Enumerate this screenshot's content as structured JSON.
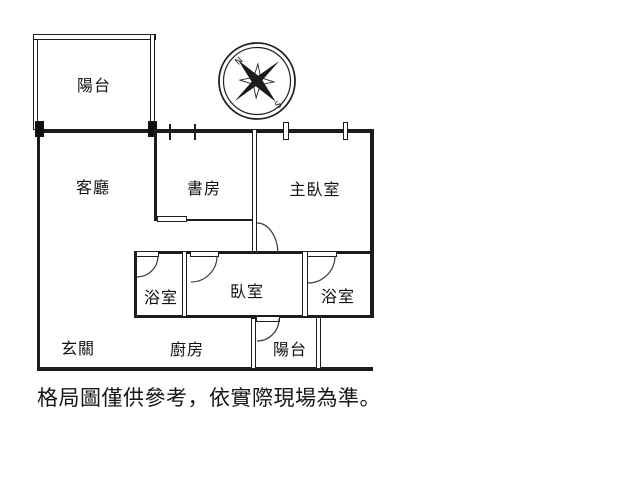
{
  "page": {
    "background_color": "#ffffff",
    "line_color": "#1c1c1c",
    "text_color": "#111111"
  },
  "floorplan": {
    "rooms": [
      {
        "id": "balcony-top",
        "label": "陽台"
      },
      {
        "id": "living-room",
        "label": "客廳"
      },
      {
        "id": "study",
        "label": "書房"
      },
      {
        "id": "master-bedroom",
        "label": "主臥室"
      },
      {
        "id": "bathroom-left",
        "label": "浴室"
      },
      {
        "id": "bedroom",
        "label": "臥室"
      },
      {
        "id": "bathroom-right",
        "label": "浴室"
      },
      {
        "id": "entryway",
        "label": "玄關"
      },
      {
        "id": "kitchen",
        "label": "廚房"
      },
      {
        "id": "balcony-bottom",
        "label": "陽台"
      }
    ],
    "compass": {
      "north_label": "N",
      "south_label": "S"
    }
  },
  "disclaimer": {
    "text": "格局圖僅供參考，依實際現場為準。"
  }
}
